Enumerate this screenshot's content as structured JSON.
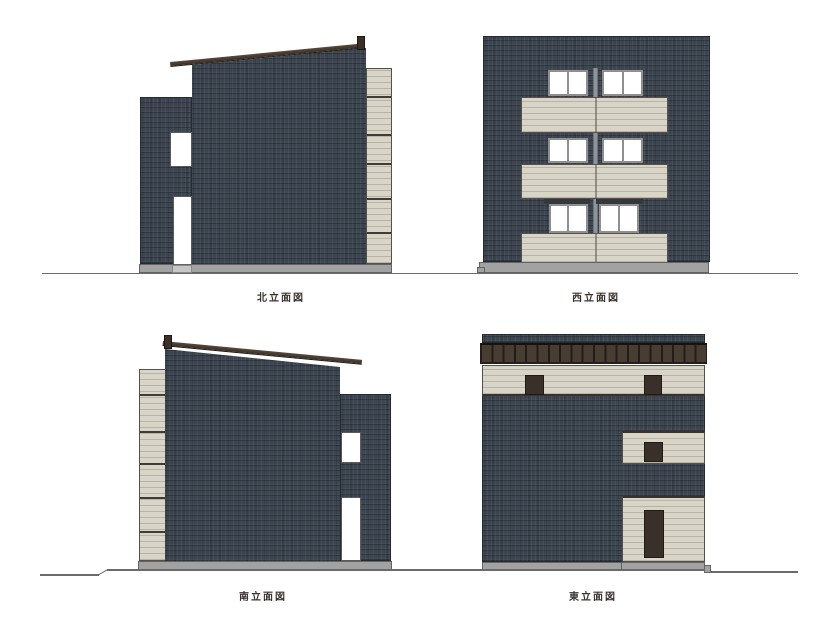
{
  "drawing": {
    "elevations": {
      "north": {
        "label": "北立面図"
      },
      "west": {
        "label": "西立面図"
      },
      "south": {
        "label": "南立面図"
      },
      "east": {
        "label": "東立面図"
      }
    },
    "palette": {
      "wall_dark": "#3b444f",
      "accent_panel_beige": "#d8d4c7",
      "roof_fascia_brown": "#44382f",
      "parapet_rib_brown": "#473d33",
      "foundation_gray": "#a2a2a2",
      "window_white": "#ffffff",
      "opening_dark_brown": "#393129",
      "ground_line_gray": "#6b6b6b",
      "label_text": "#3b3430"
    }
  }
}
